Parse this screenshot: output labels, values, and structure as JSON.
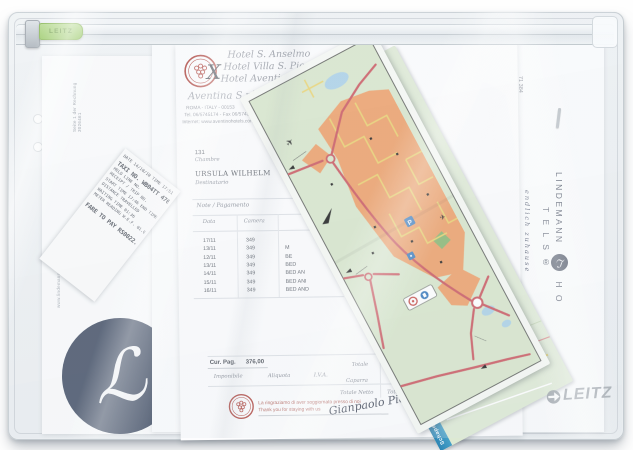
{
  "pouch": {
    "zipper_tab_label": "LEITZ",
    "brand_logo_text": "LEITZ"
  },
  "invoice": {
    "hotel_line1": "Hotel S. Anselmo",
    "hotel_line2": "Hotel Villa S. Pio",
    "hotel_line3": "Hotel Aventino",
    "mark": "X",
    "company": "Aventina S.r.l.",
    "city_line": "ROMA - ITALY - 00153",
    "tel_line": "Tel. 06/5745174 - Fax 06/5743547",
    "web_line": "Internet: www.aventinohotels.com",
    "room_number": "131",
    "room_label": "Chambre",
    "guest_name": "URSULA WILHELM",
    "guest_label": "Destinatario",
    "section_header": "Note / Pagamento",
    "col_date": "Data",
    "col_room": "Camera",
    "rows": [
      {
        "date": "17/11",
        "room": "349",
        "desc": ""
      },
      {
        "date": "13/11",
        "room": "349",
        "desc": "M"
      },
      {
        "date": "12/11",
        "room": "349",
        "desc": "BE"
      },
      {
        "date": "13/11",
        "room": "349",
        "desc": "BED"
      },
      {
        "date": "14/11",
        "room": "349",
        "desc": "BED AN"
      },
      {
        "date": "15/11",
        "room": "349",
        "desc": "BED ANI"
      },
      {
        "date": "16/11",
        "room": "349",
        "desc": "BED AND"
      }
    ],
    "total_label": "Cur. Pag.",
    "total_value": "376,00",
    "tax_labels": [
      "Imponibile",
      "Aliquota",
      "I.V.A."
    ],
    "label_totale": "Totale",
    "label_caparra": "Caparra",
    "label_totale_netto": "Totale Netto",
    "thanks_it": "La ringraziamo di aver soggiornato presso di noi",
    "thanks_en": "Thank you for staying with us",
    "signature": "Gianpaolo Pieli",
    "page_footer_vertical": "Seite 1 der Rechnung 3026461"
  },
  "receipt": {
    "lines": [
      "DATE 14/10/10  TIME 17:51",
      "TAXI NO. WB04TT 4763",
      "HELD LINE NO.",
      "RECEIPT / TRIP NO.",
      "START TIME 17:46 END TIME",
      "DISTANCE TRAVELLED",
      "WAITING TIME 01:36",
      "METER READING W.E.F. 01.04.2009",
      "FARE TO PAY RS0022.00"
    ]
  },
  "letterhead": {
    "sender_line": "LINDEMANN & Freunde GmbH",
    "addressee": [
      "Frau",
      "Ursula Wilhelm",
      "Schafgasse 23",
      "71 384"
    ],
    "brand_top": "LINDEMANN",
    "brand_monogram": "ℒ",
    "brand_bottom": "H O T E L S ®",
    "brand_tagline": "endlich zuhause",
    "website_vertical": "www.lindemann-hotels.de",
    "phone_vertical": "+49 (0)30 57 08 84 44"
  },
  "map": {
    "underfold_label": "Schapen boerderij",
    "parking_label": "P"
  },
  "colors": {
    "leitz_green": "#97c75d",
    "lindemann_navy": "#3d4960",
    "map_orange": "#ec9b62",
    "map_green": "#d6e5c9",
    "road_red": "#c84f58",
    "stamp_red": "#b0463f",
    "leitz_gray": "#939aa1"
  }
}
